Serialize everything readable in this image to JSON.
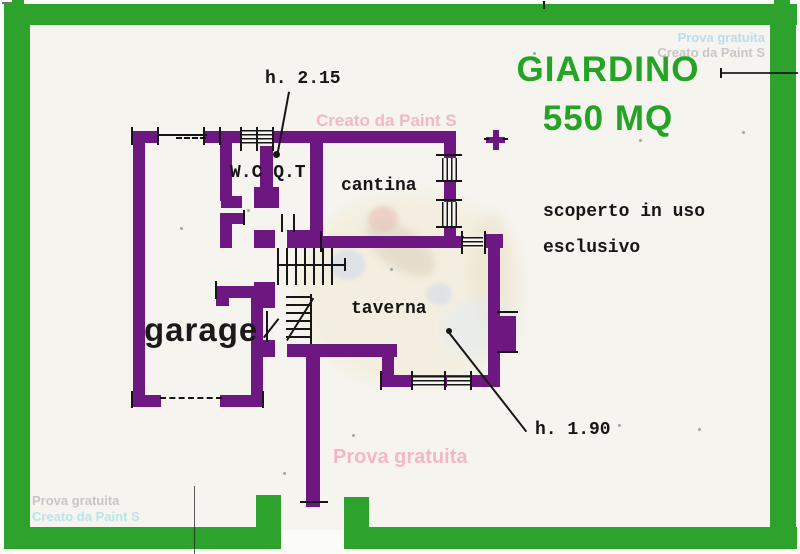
{
  "garden_label": {
    "line1": "GIARDINO",
    "line2": "550 MQ"
  },
  "room_labels": {
    "garage": "garage",
    "wc": "W.C Q.T",
    "cantina": "cantina",
    "taverna": "taverna"
  },
  "annotations": {
    "ceiling_height_upper": "h. 2.15",
    "ceiling_height_lower": "h. 1.90",
    "courtyard_note_line1": "scoperto in uso",
    "courtyard_note_line2": "esclusivo"
  },
  "watermarks": {
    "top_right_line1": "Prova gratuita",
    "top_right_line2": "Creato da Paint S",
    "top_center": "Creato da Paint S",
    "bottom_left_line1": "Prova gratuita",
    "bottom_left_line2": "Creato da Paint S",
    "bottom_center": "Prova gratuita"
  },
  "colors": {
    "wall_purple": "#6d1781",
    "frame_green": "#2da22d",
    "garden_text_green": "#24a324",
    "ink": "#161616",
    "watermark_pink": "#f4b8c2",
    "watermark_cyan": "#b9e6ea",
    "watermark_blue": "#b9ddf0",
    "watermark_gray": "#c7c7c7",
    "paper": "#f5f4ef"
  }
}
